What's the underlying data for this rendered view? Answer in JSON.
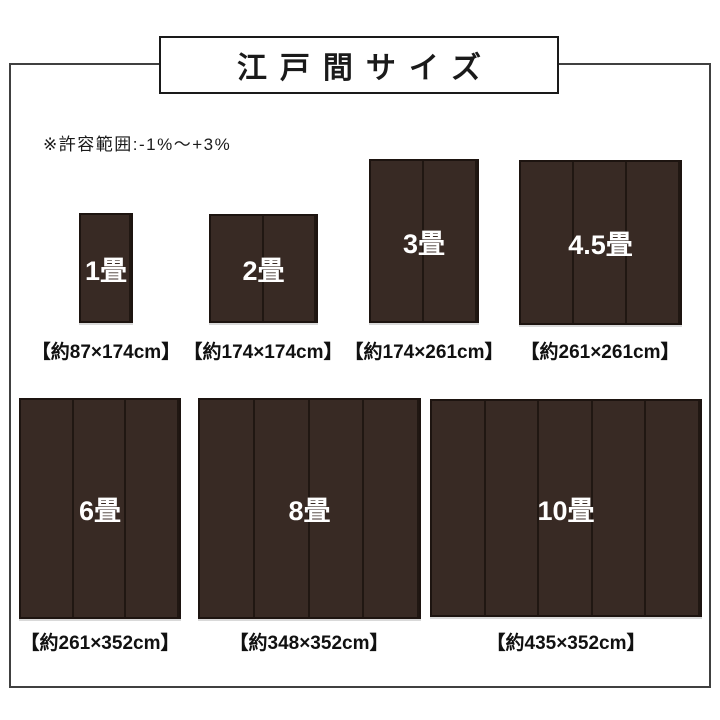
{
  "title_box": {
    "label": "江戸間サイズ"
  },
  "note": "※許容範囲:-1%〜+3%",
  "colors": {
    "background": "#ffffff",
    "frame_border": "#404040",
    "title_box_border": "#1a1a1a",
    "title_text": "#1a1a1a",
    "mat_fill": "#382a24",
    "mat_divider_line": "#201712",
    "mat_border": "#1d1410",
    "mat_label_text": "#ffffff",
    "caption_text": "#111111"
  },
  "mats": [
    {
      "label": "1畳",
      "caption": "【約87×174cm】",
      "panels": 1,
      "width_cm": 87,
      "height_cm": 174
    },
    {
      "label": "2畳",
      "caption": "【約174×174cm】",
      "panels": 2,
      "width_cm": 174,
      "height_cm": 174
    },
    {
      "label": "3畳",
      "caption": "【約174×261cm】",
      "panels": 2,
      "width_cm": 174,
      "height_cm": 261
    },
    {
      "label": "4.5畳",
      "caption": "【約261×261cm】",
      "panels": 3,
      "width_cm": 261,
      "height_cm": 261
    },
    {
      "label": "6畳",
      "caption": "【約261×352cm】",
      "panels": 3,
      "width_cm": 261,
      "height_cm": 352
    },
    {
      "label": "8畳",
      "caption": "【約348×352cm】",
      "panels": 4,
      "width_cm": 348,
      "height_cm": 352
    },
    {
      "label": "10畳",
      "caption": "【約435×352cm】",
      "panels": 5,
      "width_cm": 435,
      "height_cm": 352
    }
  ]
}
